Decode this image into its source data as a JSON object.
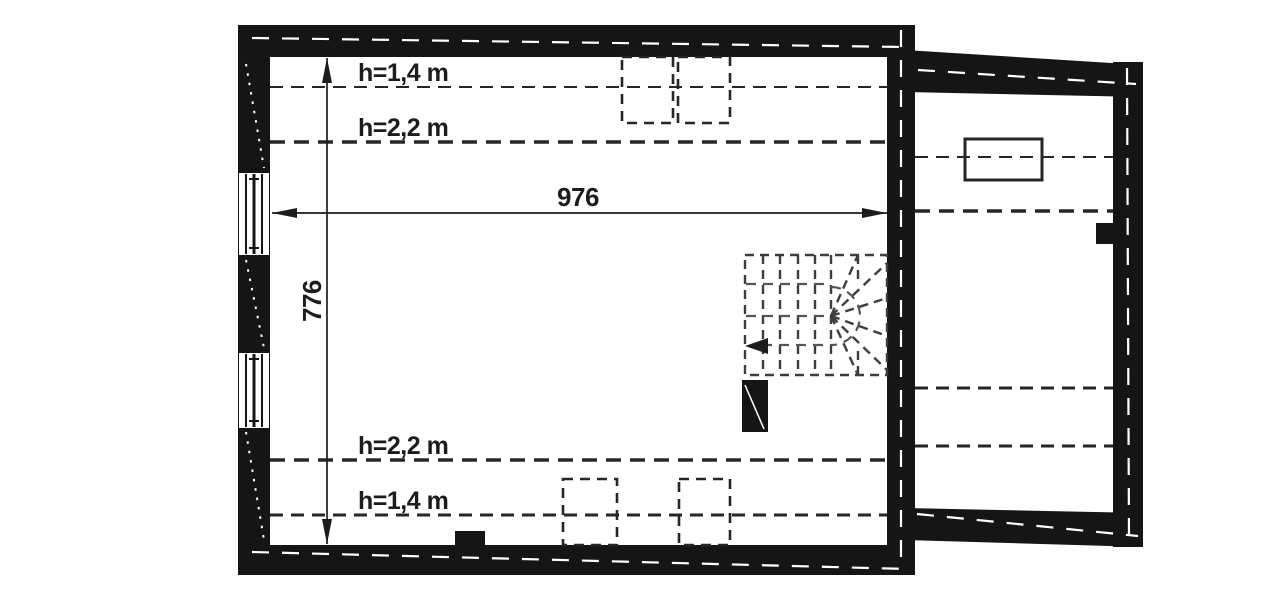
{
  "floor_plan": {
    "labels": {
      "upper_h14": "h=1,4 m",
      "upper_h22": "h=2,2 m",
      "lower_h22": "h=2,2 m",
      "lower_h14": "h=1,4 m"
    },
    "dimensions": {
      "width": "976",
      "height": "776"
    },
    "colors": {
      "wall": "#151515",
      "dash_line": "#262626",
      "stair_line": "#3d3d3d",
      "dim_line": "#1c1c1c",
      "wall_axis": "#ffffff",
      "window_fill": "#ffffff",
      "background": "#ffffff"
    }
  }
}
